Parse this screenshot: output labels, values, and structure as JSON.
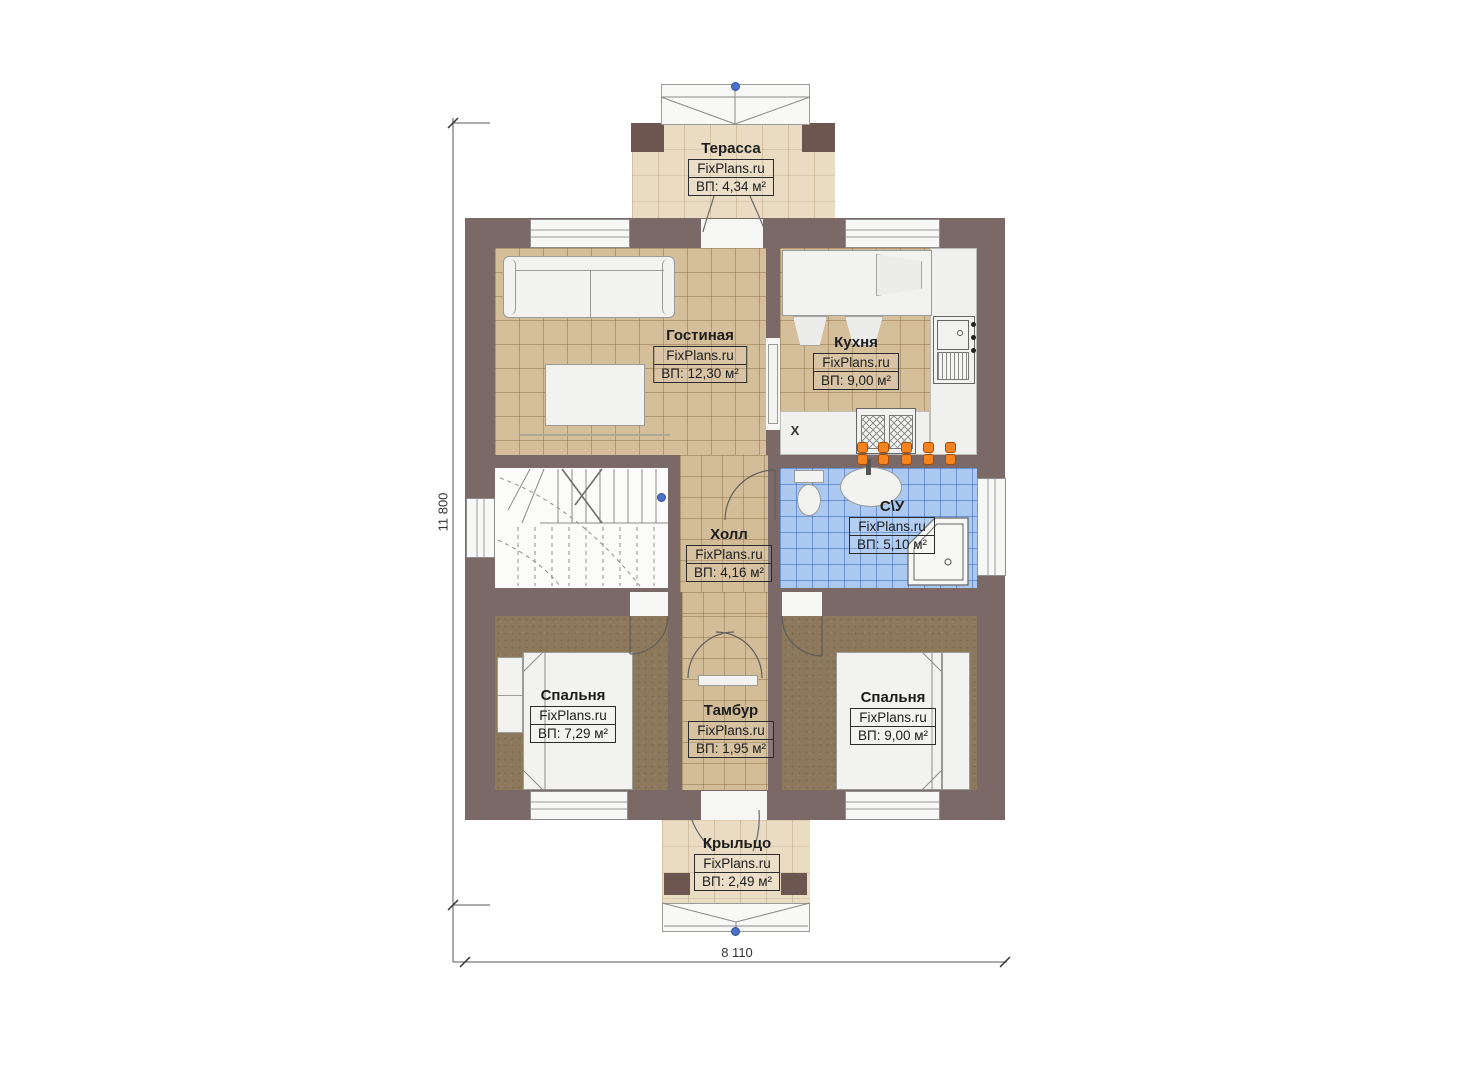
{
  "watermark": "FixPlans.ru",
  "rooms": [
    {
      "id": "terrace",
      "name": "Терасса",
      "area": "ВП: 4,34 м²"
    },
    {
      "id": "living",
      "name": "Гостиная",
      "area": "ВП: 12,30 м²"
    },
    {
      "id": "kitchen",
      "name": "Кухня",
      "area": "ВП: 9,00 м²"
    },
    {
      "id": "hall",
      "name": "Холл",
      "area": "ВП: 4,16 м²"
    },
    {
      "id": "bathroom",
      "name": "С\\У",
      "area": "ВП: 5,10 м²"
    },
    {
      "id": "bedroom-left",
      "name": "Спальня",
      "area": "ВП: 7,29 м²"
    },
    {
      "id": "tambour",
      "name": "Тамбур",
      "area": "ВП: 1,95 м²"
    },
    {
      "id": "bedroom-right",
      "name": "Спальня",
      "area": "ВП: 9,00 м²"
    },
    {
      "id": "porch",
      "name": "Крыльцо",
      "area": "ВП: 2,49 м²"
    }
  ],
  "dimensions": {
    "height": "11 800",
    "width": "8 110"
  },
  "markers": {
    "kitchen_x": "X"
  },
  "colors": {
    "wall": "#7b6968",
    "wall_post": "#6d5650",
    "floor_tan": "#d5bf9b",
    "floor_terrace": "#e9dcc3",
    "floor_bathroom": "#abc9f0",
    "floor_carpet": "#8c785a",
    "radiator_orange": "#f5831f",
    "level_marker_blue": "#4a72c8"
  }
}
